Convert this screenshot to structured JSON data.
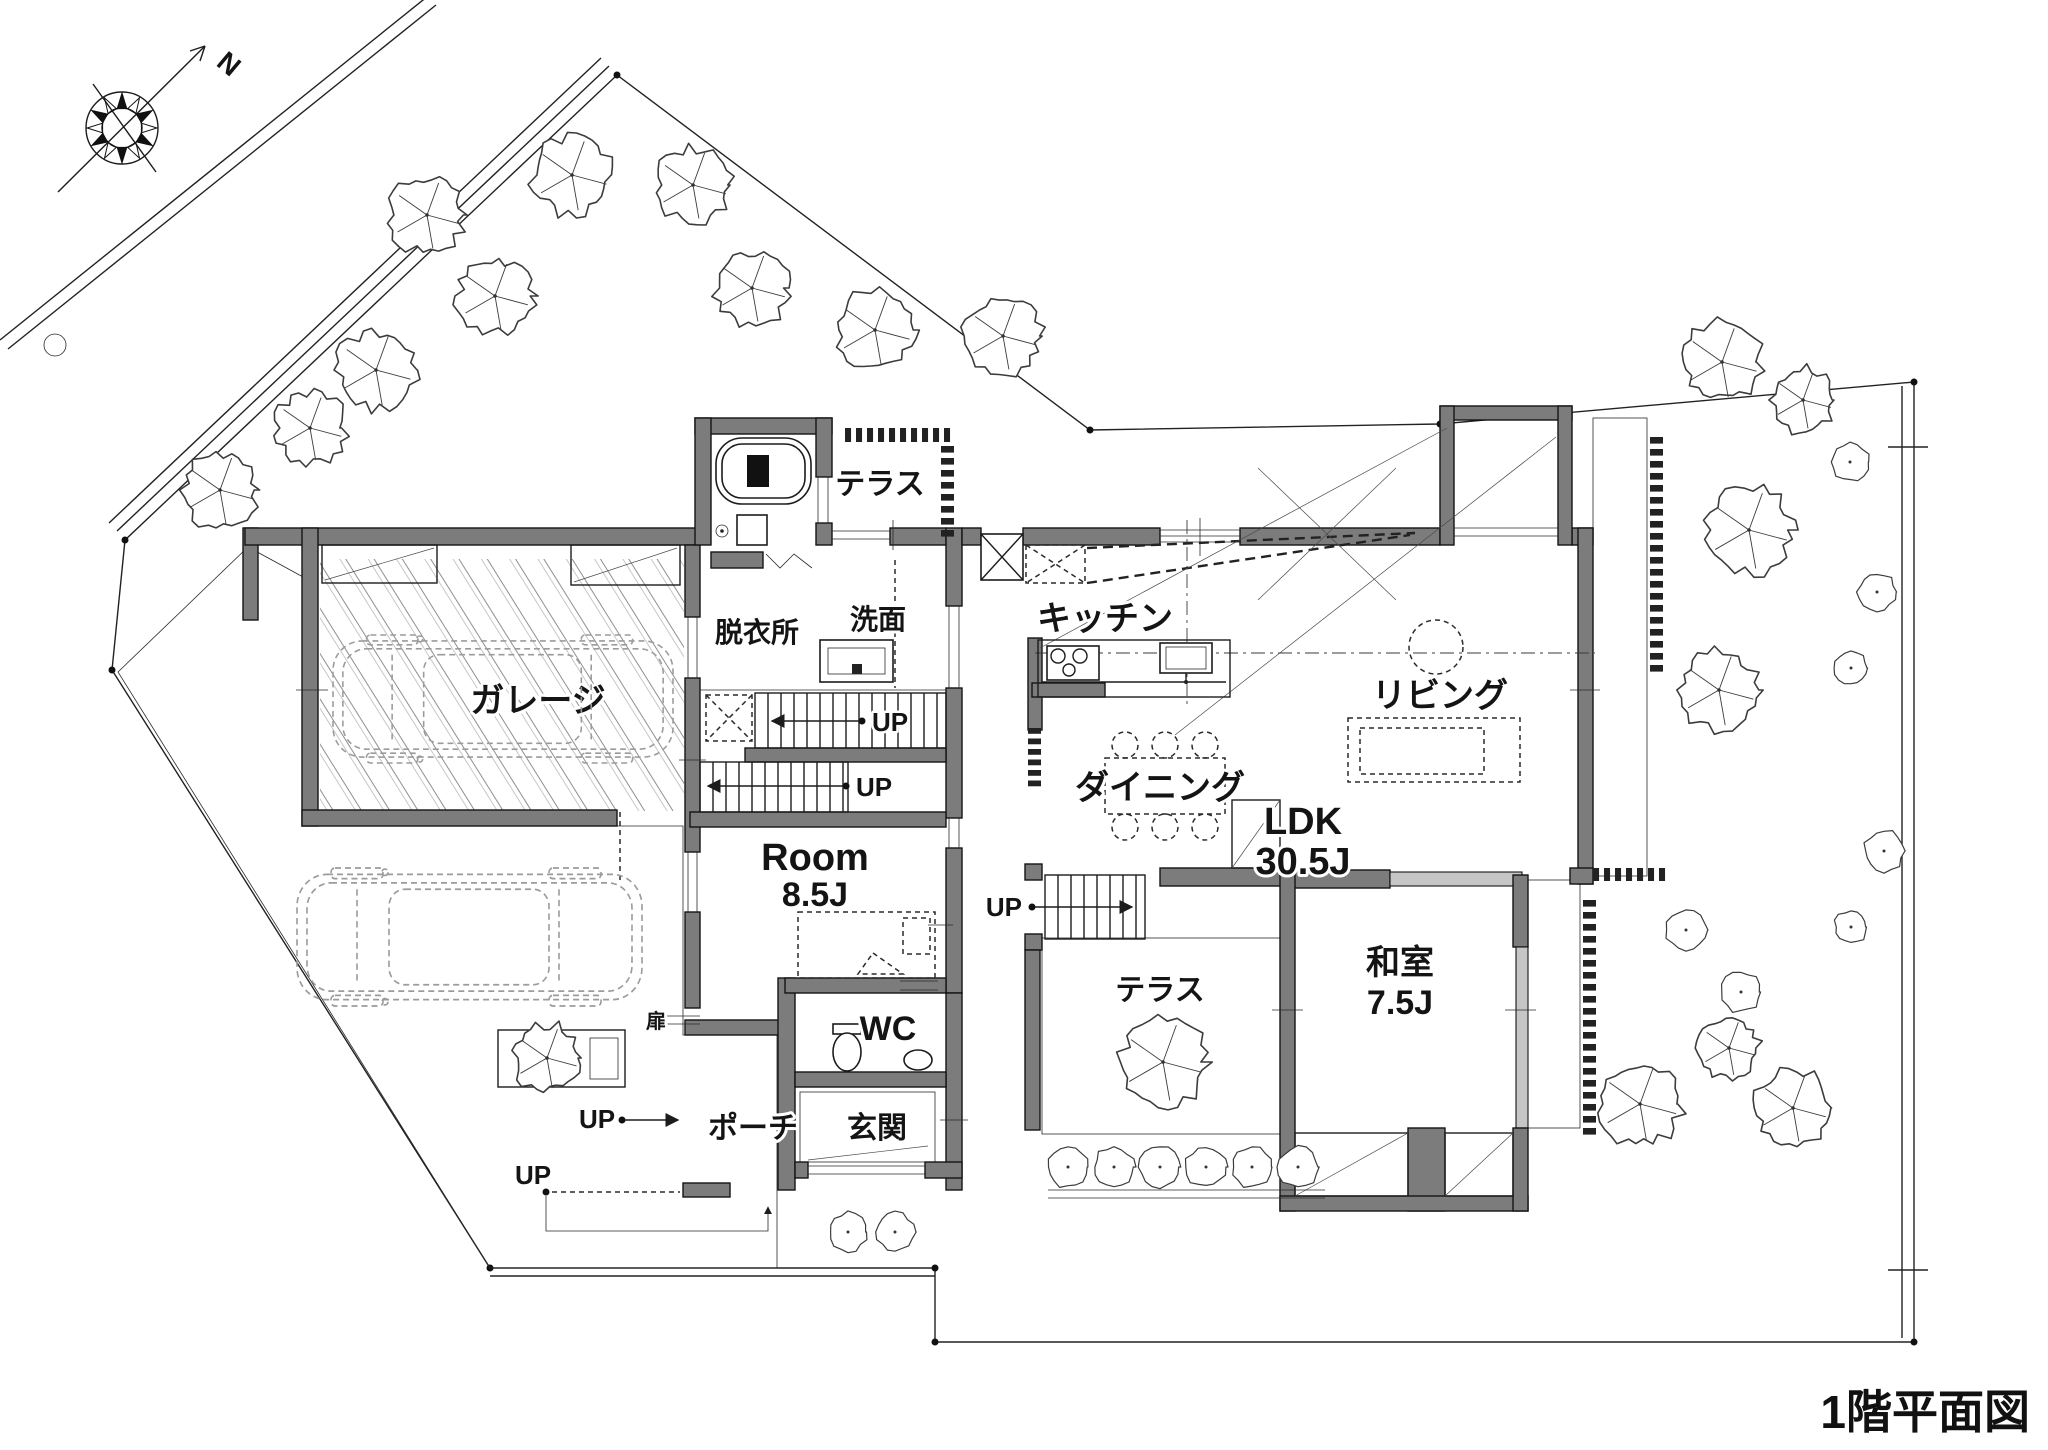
{
  "title": "1階平面図",
  "compass": {
    "north": "N"
  },
  "labels": {
    "garage": "ガレージ",
    "dressing": "脱衣所",
    "washroom": "洗面",
    "terrace_top": "テラス",
    "kitchen": "キッチン",
    "dining": "ダイニング",
    "living": "リビング",
    "ldk": "LDK",
    "ldk_size": "30.5J",
    "room": "Room",
    "room_size": "8.5J",
    "washitsu": "和室",
    "washitsu_size": "7.5J",
    "wc": "WC",
    "entrance": "玄関",
    "porch": "ポーチ",
    "terrace_garden": "テラス",
    "door": "扉",
    "up": "UP"
  }
}
